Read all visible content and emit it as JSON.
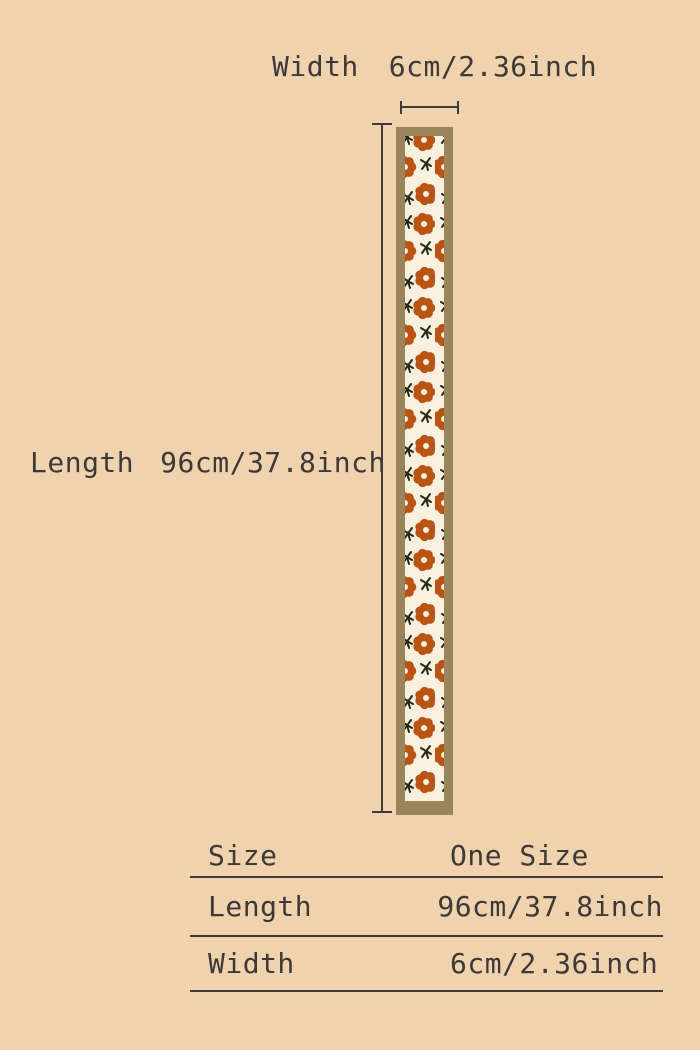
{
  "colors": {
    "background": "#f0d3ac",
    "text": "#3a3a3a",
    "line": "#3c3c3c",
    "strip-border": "#9a855a",
    "strip-fill": "#f8f1e0",
    "flower": "#bc5311",
    "stem": "#232a12"
  },
  "diagram": {
    "width": {
      "label": "Width",
      "value": "6cm/2.36inch"
    },
    "length": {
      "label": "Length",
      "value": "96cm/37.8inch"
    }
  },
  "size_table": {
    "rows": [
      {
        "label": "Size",
        "value": "One Size"
      },
      {
        "label": "Length",
        "value": "96cm/37.8inch"
      },
      {
        "label": "Width",
        "value": "6cm/2.36inch"
      }
    ]
  }
}
